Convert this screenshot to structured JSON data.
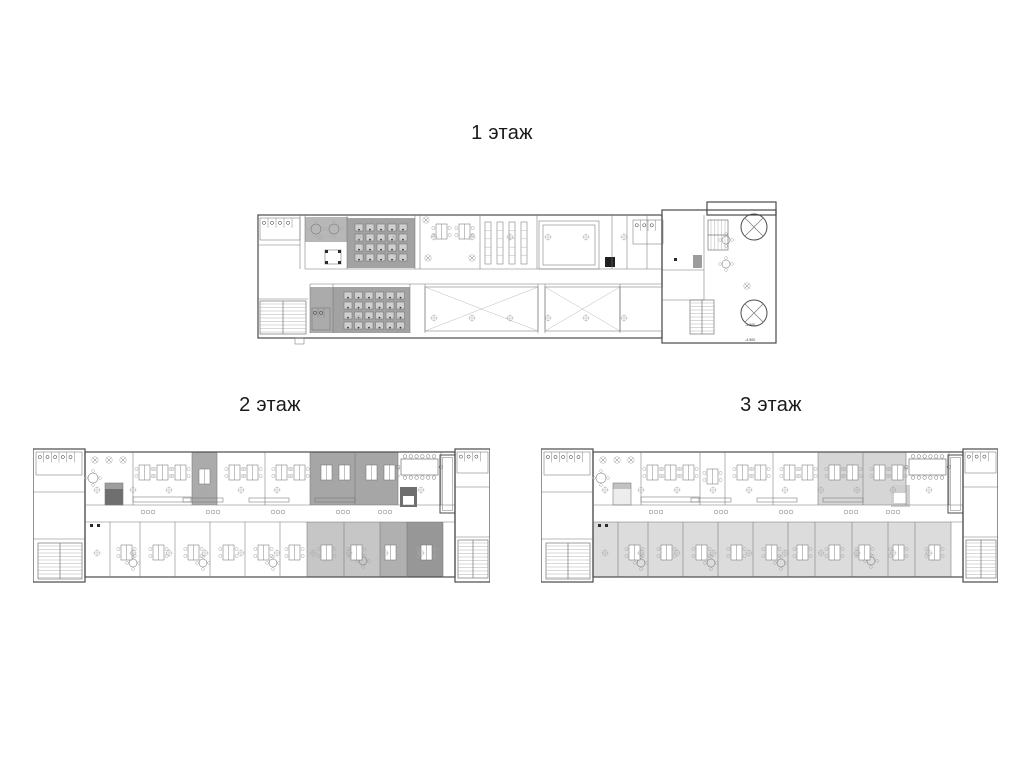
{
  "sheet": {
    "background": "#ffffff",
    "width": 1024,
    "height": 768
  },
  "palette": {
    "wall": "#4a4a4a",
    "line": "#767676",
    "faint": "#a9a9a9",
    "fixture": "#2b2b2b",
    "desk_cell": "#cfcfcf",
    "white": "#ffffff",
    "label_color": "#1a1a1a"
  },
  "plans": {
    "floor1": {
      "w": 524,
      "h": 150,
      "shapes": [
        {
          "t": "rect",
          "x": 2,
          "y": 15,
          "w": 404,
          "h": 123,
          "wall": 1
        },
        {
          "t": "rect",
          "x": 406,
          "y": 10,
          "w": 114,
          "h": 133,
          "wall": 1
        },
        {
          "t": "rect",
          "x": 451,
          "y": 2,
          "w": 69,
          "h": 13,
          "wall": 1
        },
        {
          "t": "line",
          "x1": 49,
          "y1": 69,
          "x2": 406,
          "y2": 69
        },
        {
          "t": "line",
          "x1": 54,
          "y1": 84,
          "x2": 406,
          "y2": 84
        },
        {
          "t": "vls",
          "xs": [
            44,
            49,
            91,
            159,
            164,
            224,
            281,
            356,
            371,
            391
          ],
          "y1": 15,
          "y2": 69
        },
        {
          "t": "vls",
          "xs": [
            54,
            77,
            154,
            169,
            282,
            289,
            364
          ],
          "y1": 84,
          "y2": 133
        },
        {
          "t": "line",
          "x1": 2,
          "y1": 45,
          "x2": 44,
          "y2": 45
        },
        {
          "t": "line",
          "x1": 2,
          "y1": 99,
          "x2": 52,
          "y2": 99
        },
        {
          "t": "rect",
          "x": 283,
          "y": 21,
          "w": 60,
          "h": 48
        },
        {
          "t": "rect",
          "x": 287,
          "y": 25,
          "w": 52,
          "h": 40
        },
        {
          "t": "line",
          "x1": 406,
          "y1": 70,
          "x2": 448,
          "y2": 70
        },
        {
          "t": "line",
          "x1": 448,
          "y1": 15,
          "x2": 448,
          "y2": 100
        },
        {
          "t": "line",
          "x1": 406,
          "y1": 100,
          "x2": 448,
          "y2": 100
        },
        {
          "t": "wc",
          "x": 4,
          "y": 18,
          "w": 40,
          "h": 22,
          "n": 4
        },
        {
          "t": "stairs",
          "x": 4,
          "y": 101,
          "w": 46,
          "h": 33,
          "o": "v"
        },
        {
          "t": "rect",
          "x": 39,
          "y": 138,
          "w": 9,
          "h": 6
        },
        {
          "t": "rtables",
          "pts": [
            [
              60,
              29,
              5
            ],
            [
              78,
              29,
              5
            ],
            [
              470,
              40,
              4
            ],
            [
              470,
              64,
              4
            ]
          ]
        },
        {
          "t": "ctable",
          "x": 69,
          "y": 50,
          "w": 16,
          "h": 14
        },
        {
          "t": "grid",
          "x": 99,
          "y": 24,
          "cols": 5,
          "rows": 4,
          "cw": 8,
          "ch": 7,
          "gx": 11,
          "gy": 10
        },
        {
          "t": "grid",
          "x": 88,
          "y": 92,
          "cols": 6,
          "rows": 4,
          "cw": 8,
          "ch": 7,
          "gx": 10.5,
          "gy": 10
        },
        {
          "t": "wc",
          "x": 56,
          "y": 108,
          "w": 18,
          "h": 22,
          "n": 2
        },
        {
          "t": "clusters",
          "pts": [
            [
              180,
              24
            ],
            [
              203,
              24
            ]
          ]
        },
        {
          "t": "plants",
          "pts": [
            [
              172,
              58
            ],
            [
              216,
              58
            ],
            [
              170,
              20
            ],
            [
              491,
              86
            ]
          ]
        },
        {
          "t": "racks",
          "x": 229,
          "y": 22,
          "w": 6,
          "h": 42,
          "n": 4,
          "step": 12
        },
        {
          "t": "diag",
          "x": 169,
          "y": 87,
          "w": 113,
          "h": 44
        },
        {
          "t": "diag",
          "x": 289,
          "y": 87,
          "w": 75,
          "h": 44
        },
        {
          "t": "rect",
          "x": 364,
          "y": 87,
          "w": 42,
          "h": 44
        },
        {
          "t": "wc",
          "x": 377,
          "y": 20,
          "w": 30,
          "h": 24,
          "n": 3
        },
        {
          "t": "stairs",
          "x": 452,
          "y": 20,
          "w": 20,
          "h": 30,
          "o": "h"
        },
        {
          "t": "circlex",
          "cx": 498,
          "cy": 27,
          "r": 13
        },
        {
          "t": "circlex",
          "cx": 498,
          "cy": 113,
          "r": 13
        },
        {
          "t": "stairs",
          "x": 434,
          "y": 100,
          "w": 24,
          "h": 34,
          "o": "v"
        },
        {
          "t": "cols",
          "x1": 64,
          "x2": 400,
          "y": 37,
          "step": 38
        },
        {
          "t": "cols",
          "x1": 64,
          "x2": 400,
          "y": 118,
          "step": 38
        },
        {
          "t": "dots",
          "pts": [
            [
              418,
              58
            ]
          ]
        },
        {
          "t": "txt",
          "x": 489,
          "y": 126,
          "s": "-4.500"
        },
        {
          "t": "txt",
          "x": 489,
          "y": 141,
          "s": "-4.500"
        }
      ]
    },
    "wing": {
      "w": 457,
      "h": 137,
      "shapes": [
        {
          "t": "rect",
          "x": 0,
          "y": 2,
          "w": 52,
          "h": 133,
          "wall": 1
        },
        {
          "t": "rect",
          "x": 52,
          "y": 5,
          "w": 370,
          "h": 125,
          "wall": 1
        },
        {
          "t": "rect",
          "x": 422,
          "y": 2,
          "w": 35,
          "h": 133,
          "wall": 1
        },
        {
          "t": "line",
          "x1": 52,
          "y1": 58,
          "x2": 422,
          "y2": 58
        },
        {
          "t": "line",
          "x1": 52,
          "y1": 75,
          "x2": 422,
          "y2": 75
        },
        {
          "t": "vls",
          "xs": [
            100,
            159,
            184,
            232,
            277,
            322,
            365,
            408
          ],
          "y1": 5,
          "y2": 58
        },
        {
          "t": "vls",
          "xs": [
            77,
            107,
            142,
            177,
            212,
            247,
            274,
            311,
            347,
            374,
            410
          ],
          "y1": 75,
          "y2": 130
        },
        {
          "t": "line",
          "x1": 0,
          "y1": 45,
          "x2": 52,
          "y2": 45
        },
        {
          "t": "line",
          "x1": 0,
          "y1": 92,
          "x2": 52,
          "y2": 92
        },
        {
          "t": "line",
          "x1": 422,
          "y1": 40,
          "x2": 457,
          "y2": 40
        },
        {
          "t": "line",
          "x1": 422,
          "y1": 90,
          "x2": 457,
          "y2": 90
        },
        {
          "t": "shaft",
          "x": 407,
          "y": 8,
          "w": 15,
          "h": 58
        },
        {
          "t": "wc",
          "x": 3,
          "y": 5,
          "w": 46,
          "h": 23,
          "n": 5
        },
        {
          "t": "stairs",
          "x": 5,
          "y": 96,
          "w": 44,
          "h": 36,
          "o": "v"
        },
        {
          "t": "wc",
          "x": 424,
          "y": 5,
          "w": 31,
          "h": 21,
          "n": 3
        },
        {
          "t": "stairs",
          "x": 425,
          "y": 93,
          "w": 30,
          "h": 38,
          "o": "v"
        },
        {
          "t": "plants",
          "pts": [
            [
              62,
              13
            ],
            [
              76,
              13
            ],
            [
              90,
              13
            ]
          ]
        },
        {
          "t": "rtables",
          "pts": [
            [
              60,
              31,
              5
            ],
            [
              100,
              116,
              4
            ],
            [
              170,
              116,
              4
            ],
            [
              240,
              116,
              4
            ],
            [
              330,
              114,
              4
            ]
          ]
        },
        {
          "t": "rect",
          "x": 72,
          "y": 36,
          "w": 18,
          "h": 22
        },
        {
          "t": "rect",
          "x": 100,
          "y": 50,
          "w": 58,
          "h": 5
        },
        {
          "t": "clusters",
          "pts": [
            [
              106,
              18
            ],
            [
              124,
              18
            ],
            [
              142,
              18
            ],
            [
              166,
              22
            ],
            [
              196,
              18
            ],
            [
              214,
              18
            ],
            [
              243,
              18
            ],
            [
              261,
              18
            ],
            [
              288,
              18
            ],
            [
              306,
              18
            ],
            [
              333,
              18
            ],
            [
              351,
              18
            ]
          ]
        },
        {
          "t": "seats",
          "pts": [
            [
              115,
              65
            ],
            [
              180,
              65
            ],
            [
              245,
              65
            ],
            [
              310,
              65
            ],
            [
              352,
              65
            ]
          ]
        },
        {
          "t": "rect",
          "x": 150,
          "y": 51,
          "w": 40,
          "h": 4
        },
        {
          "t": "rect",
          "x": 216,
          "y": 51,
          "w": 40,
          "h": 4
        },
        {
          "t": "rect",
          "x": 282,
          "y": 51,
          "w": 40,
          "h": 4
        },
        {
          "t": "conf",
          "x": 368,
          "y": 12,
          "w": 37,
          "h": 16
        },
        {
          "t": "clusters",
          "pts": [
            [
              88,
              98
            ],
            [
              120,
              98
            ],
            [
              155,
              98
            ],
            [
              190,
              98
            ],
            [
              225,
              98
            ],
            [
              256,
              98
            ],
            [
              288,
              98
            ],
            [
              318,
              98
            ],
            [
              352,
              98
            ],
            [
              388,
              98
            ]
          ]
        },
        {
          "t": "dots",
          "pts": [
            [
              57,
              77
            ],
            [
              64,
              77
            ]
          ]
        },
        {
          "t": "cols",
          "x1": 64,
          "x2": 420,
          "y": 43,
          "step": 36
        },
        {
          "t": "cols",
          "x1": 64,
          "x2": 420,
          "y": 106,
          "step": 36
        }
      ]
    }
  },
  "floors": [
    {
      "label": "1 этаж",
      "label_x": 502,
      "label_y": 121,
      "plan": "floor1",
      "x": 256,
      "y": 200,
      "fills": [
        {
          "x": 49,
          "y": 17,
          "w": 43,
          "h": 25,
          "f": "#b7b7b7"
        },
        {
          "x": 91,
          "y": 18,
          "w": 68,
          "h": 50,
          "f": "#a2a2a2"
        },
        {
          "x": 54,
          "y": 87,
          "w": 23,
          "h": 46,
          "f": "#ababab"
        },
        {
          "x": 77,
          "y": 87,
          "w": 77,
          "h": 46,
          "f": "#a2a2a2"
        },
        {
          "x": 349,
          "y": 57,
          "w": 10,
          "h": 10,
          "f": "#202020"
        },
        {
          "x": 437,
          "y": 55,
          "w": 9,
          "h": 13,
          "f": "#9c9c9c"
        }
      ]
    },
    {
      "label": "2 этаж",
      "label_x": 270,
      "label_y": 393,
      "plan": "wing",
      "x": 33,
      "y": 447,
      "fills": [
        {
          "x": 159,
          "y": 5,
          "w": 25,
          "h": 53,
          "f": "#ababab"
        },
        {
          "x": 277,
          "y": 5,
          "w": 45,
          "h": 53,
          "f": "#a6a6a6"
        },
        {
          "x": 322,
          "y": 5,
          "w": 43,
          "h": 53,
          "f": "#a6a6a6"
        },
        {
          "x": 72,
          "y": 36,
          "w": 18,
          "h": 22,
          "f": "#6f6f6f"
        },
        {
          "x": 72,
          "y": 36,
          "w": 18,
          "h": 6,
          "f": "#9d9d9d"
        },
        {
          "x": 367,
          "y": 40,
          "w": 17,
          "h": 20,
          "f": "#6e6e6e"
        },
        {
          "x": 370,
          "y": 49,
          "w": 11,
          "h": 9,
          "f": "#ffffff"
        },
        {
          "x": 274,
          "y": 75,
          "w": 73,
          "h": 55,
          "f": "#c6c6c6"
        },
        {
          "x": 347,
          "y": 75,
          "w": 27,
          "h": 55,
          "f": "#b0b0b0"
        },
        {
          "x": 374,
          "y": 75,
          "w": 36,
          "h": 55,
          "f": "#979797"
        }
      ]
    },
    {
      "label": "3 этаж",
      "label_x": 771,
      "label_y": 393,
      "plan": "wing",
      "x": 541,
      "y": 447,
      "fills": [
        {
          "x": 277,
          "y": 5,
          "w": 45,
          "h": 53,
          "f": "#d6d6d6"
        },
        {
          "x": 322,
          "y": 5,
          "w": 43,
          "h": 53,
          "f": "#d6d6d6"
        },
        {
          "x": 72,
          "y": 36,
          "w": 18,
          "h": 22,
          "f": "#ededed"
        },
        {
          "x": 72,
          "y": 36,
          "w": 18,
          "h": 6,
          "f": "#c2c2c2"
        },
        {
          "x": 350,
          "y": 38,
          "w": 19,
          "h": 22,
          "f": "#d0d0d0"
        },
        {
          "x": 353,
          "y": 46,
          "w": 12,
          "h": 10,
          "f": "#ffffff"
        },
        {
          "x": 52,
          "y": 75,
          "w": 358,
          "h": 55,
          "f": "#dcdcdc"
        }
      ]
    }
  ]
}
